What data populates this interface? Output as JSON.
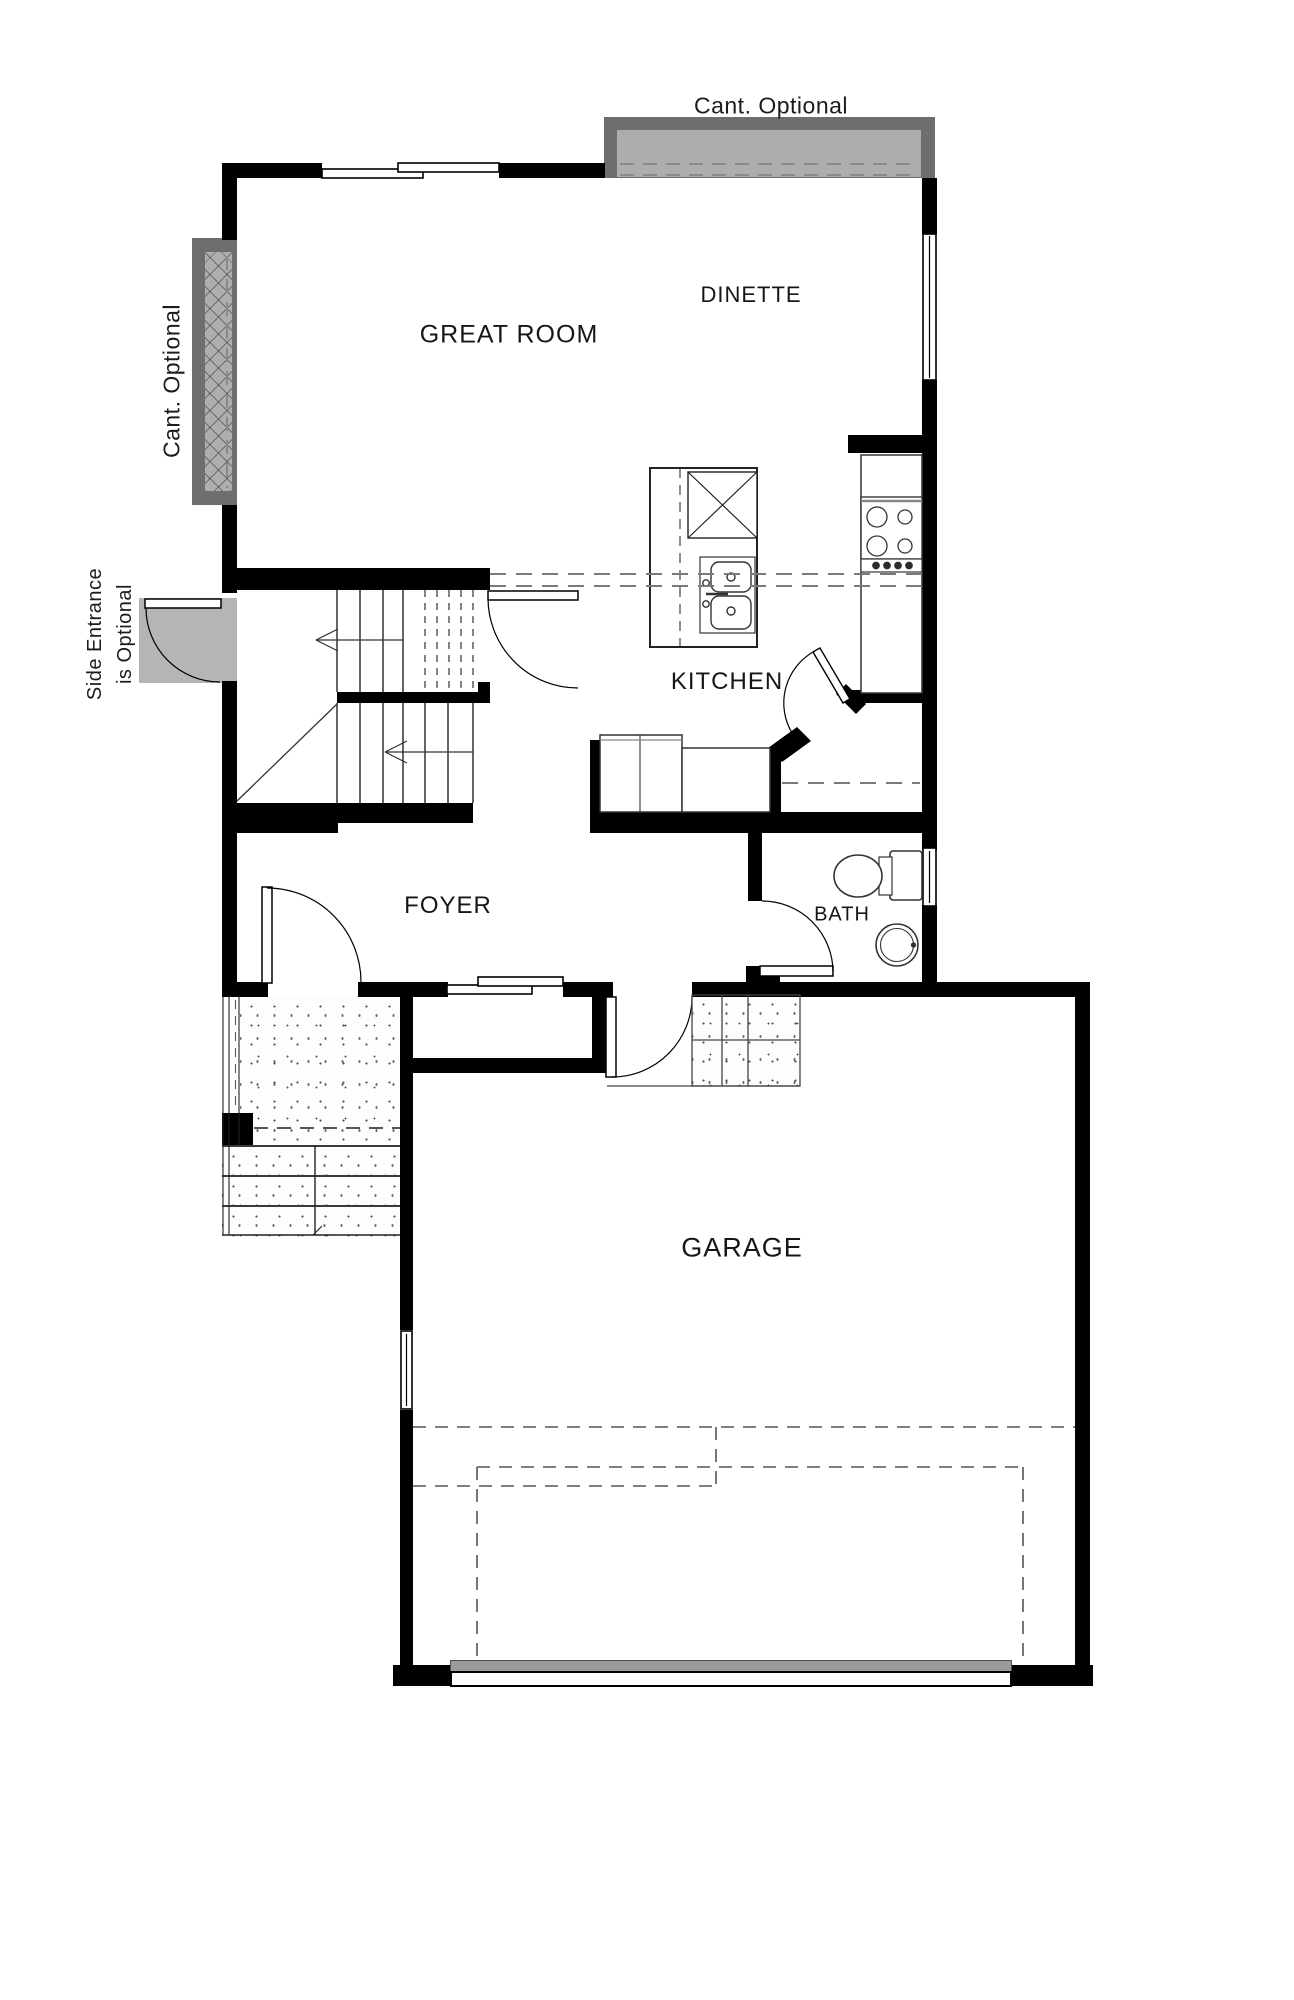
{
  "rooms": [
    {
      "id": "great-room",
      "label": "GREAT ROOM"
    },
    {
      "id": "dinette",
      "label": "DINETTE"
    },
    {
      "id": "kitchen",
      "label": "KITCHEN"
    },
    {
      "id": "foyer",
      "label": "FOYER"
    },
    {
      "id": "bath",
      "label": "BATH"
    },
    {
      "id": "garage",
      "label": "GARAGE"
    }
  ],
  "annotations": {
    "cant_top": "Cant. Optional",
    "cant_left": "Cant. Optional",
    "side_entrance_line1": "Side Entrance",
    "side_entrance_line2": "is Optional"
  },
  "colors": {
    "wall": "#000000",
    "cantilever_outer": "#6e6e6e",
    "cantilever_inner": "#adadad",
    "door_swing_fill": "#b5b5b5",
    "garage_door_band": "#9b9b9b",
    "dashed_line": "#7a7a7a"
  }
}
